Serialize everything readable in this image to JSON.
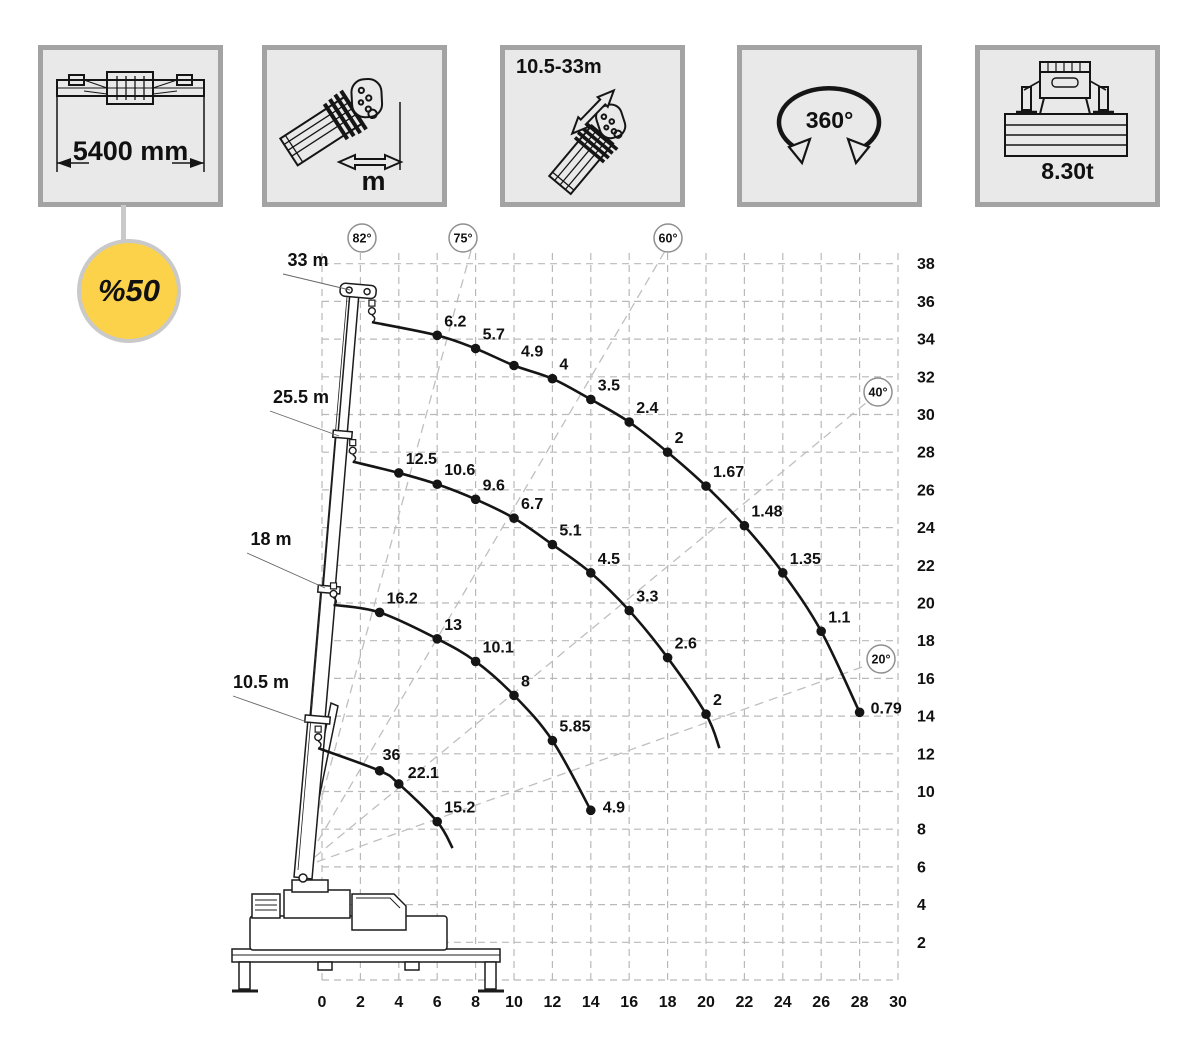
{
  "page": {
    "background": "#ffffff"
  },
  "spec_boxes": [
    {
      "name": "outrigger-span",
      "label": "5400 mm"
    },
    {
      "name": "load-radius",
      "label": "m"
    },
    {
      "name": "boom-length-range",
      "label": "10.5-33m"
    },
    {
      "name": "slewing-range",
      "label": "360°"
    },
    {
      "name": "counterweight",
      "label": "8.30t"
    }
  ],
  "badge": {
    "text": "%50",
    "fill": "#fbd24a",
    "ring": "#c9c9c9"
  },
  "chart_data": {
    "type": "line",
    "xlabel": "",
    "ylabel": "",
    "xlim": [
      0,
      30
    ],
    "ylim": [
      0,
      38
    ],
    "grid": true,
    "x_ticks": [
      0,
      2,
      4,
      6,
      8,
      10,
      12,
      14,
      16,
      18,
      20,
      22,
      24,
      26,
      28,
      30
    ],
    "y_ticks": [
      2,
      4,
      6,
      8,
      10,
      12,
      14,
      16,
      18,
      20,
      22,
      24,
      26,
      28,
      30,
      32,
      34,
      36,
      38
    ],
    "pivot": {
      "x": -1,
      "y": 6
    },
    "angles": [
      {
        "label": "82°",
        "deg": 82,
        "ray": false,
        "cx": 362,
        "cy": 238
      },
      {
        "label": "75°",
        "deg": 75,
        "ray": true,
        "cx": 463,
        "cy": 238
      },
      {
        "label": "60°",
        "deg": 60,
        "ray": true,
        "cx": 668,
        "cy": 238
      },
      {
        "label": "40°",
        "deg": 40,
        "ray": true,
        "cx": 878,
        "cy": 392
      },
      {
        "label": "20°",
        "deg": 20,
        "ray": true,
        "cx": 881,
        "cy": 659
      }
    ],
    "series": [
      {
        "name": "33 m",
        "points": [
          {
            "x": 2.6,
            "y": 34.9
          },
          {
            "x": 6,
            "y": 34.2,
            "load": "6.2"
          },
          {
            "x": 8,
            "y": 33.5,
            "load": "5.7"
          },
          {
            "x": 10,
            "y": 32.6,
            "load": "4.9"
          },
          {
            "x": 12,
            "y": 31.9,
            "load": "4"
          },
          {
            "x": 14,
            "y": 30.8,
            "load": "3.5"
          },
          {
            "x": 16,
            "y": 29.6,
            "load": "2.4"
          },
          {
            "x": 18,
            "y": 28.0,
            "load": "2"
          },
          {
            "x": 20,
            "y": 26.2,
            "load": "1.67"
          },
          {
            "x": 22,
            "y": 24.1,
            "load": "1.48"
          },
          {
            "x": 24,
            "y": 21.6,
            "load": "1.35"
          },
          {
            "x": 26,
            "y": 18.5,
            "load": "1.1"
          },
          {
            "x": 28,
            "y": 14.2,
            "load": "0.79",
            "dx": 11,
            "dy": 1
          }
        ]
      },
      {
        "name": "25.5 m",
        "points": [
          {
            "x": 1.6,
            "y": 27.5
          },
          {
            "x": 4,
            "y": 26.9,
            "load": "12.5"
          },
          {
            "x": 6,
            "y": 26.3,
            "load": "10.6"
          },
          {
            "x": 8,
            "y": 25.5,
            "load": "9.6"
          },
          {
            "x": 10,
            "y": 24.5,
            "load": "6.7"
          },
          {
            "x": 12,
            "y": 23.1,
            "load": "5.1"
          },
          {
            "x": 14,
            "y": 21.6,
            "load": "4.5"
          },
          {
            "x": 16,
            "y": 19.6,
            "load": "3.3"
          },
          {
            "x": 18,
            "y": 17.1,
            "load": "2.6"
          },
          {
            "x": 20,
            "y": 14.1,
            "load": "2"
          },
          {
            "x": 20.7,
            "y": 12.3,
            "end": true
          }
        ]
      },
      {
        "name": "18 m",
        "points": [
          {
            "x": 0.6,
            "y": 19.9
          },
          {
            "x": 3,
            "y": 19.5,
            "load": "16.2"
          },
          {
            "x": 6,
            "y": 18.1,
            "load": "13"
          },
          {
            "x": 8,
            "y": 16.9,
            "load": "10.1"
          },
          {
            "x": 10,
            "y": 15.1,
            "load": "8"
          },
          {
            "x": 12,
            "y": 12.7,
            "load": "5.85"
          },
          {
            "x": 14,
            "y": 9.0,
            "load": "4.9",
            "dx": 12,
            "dy": 2
          }
        ]
      },
      {
        "name": "10.5 m",
        "points": [
          {
            "x": -0.2,
            "y": 12.3
          },
          {
            "x": 3,
            "y": 11.1,
            "load": "36",
            "dx": 3,
            "dy": -11
          },
          {
            "x": 4,
            "y": 10.4,
            "load": "22.1",
            "dx": 9,
            "dy": -6
          },
          {
            "x": 6,
            "y": 8.4,
            "load": "15.2"
          },
          {
            "x": 6.8,
            "y": 7.0,
            "end": true
          }
        ]
      }
    ],
    "boom_labels": [
      {
        "label": "33 m",
        "tx": 308,
        "ty": 266,
        "lx": 283,
        "ly": 274,
        "ax": 350,
        "ay": 290
      },
      {
        "label": "25.5 m",
        "tx": 301,
        "ty": 403,
        "lx": 270,
        "ly": 411,
        "ax": 339,
        "ay": 436
      },
      {
        "label": "18 m",
        "tx": 271,
        "ty": 545,
        "lx": 247,
        "ly": 553,
        "ax": 325,
        "ay": 588
      },
      {
        "label": "10.5 m",
        "tx": 261,
        "ty": 688,
        "lx": 233,
        "ly": 696,
        "ax": 307,
        "ay": 722
      }
    ]
  }
}
